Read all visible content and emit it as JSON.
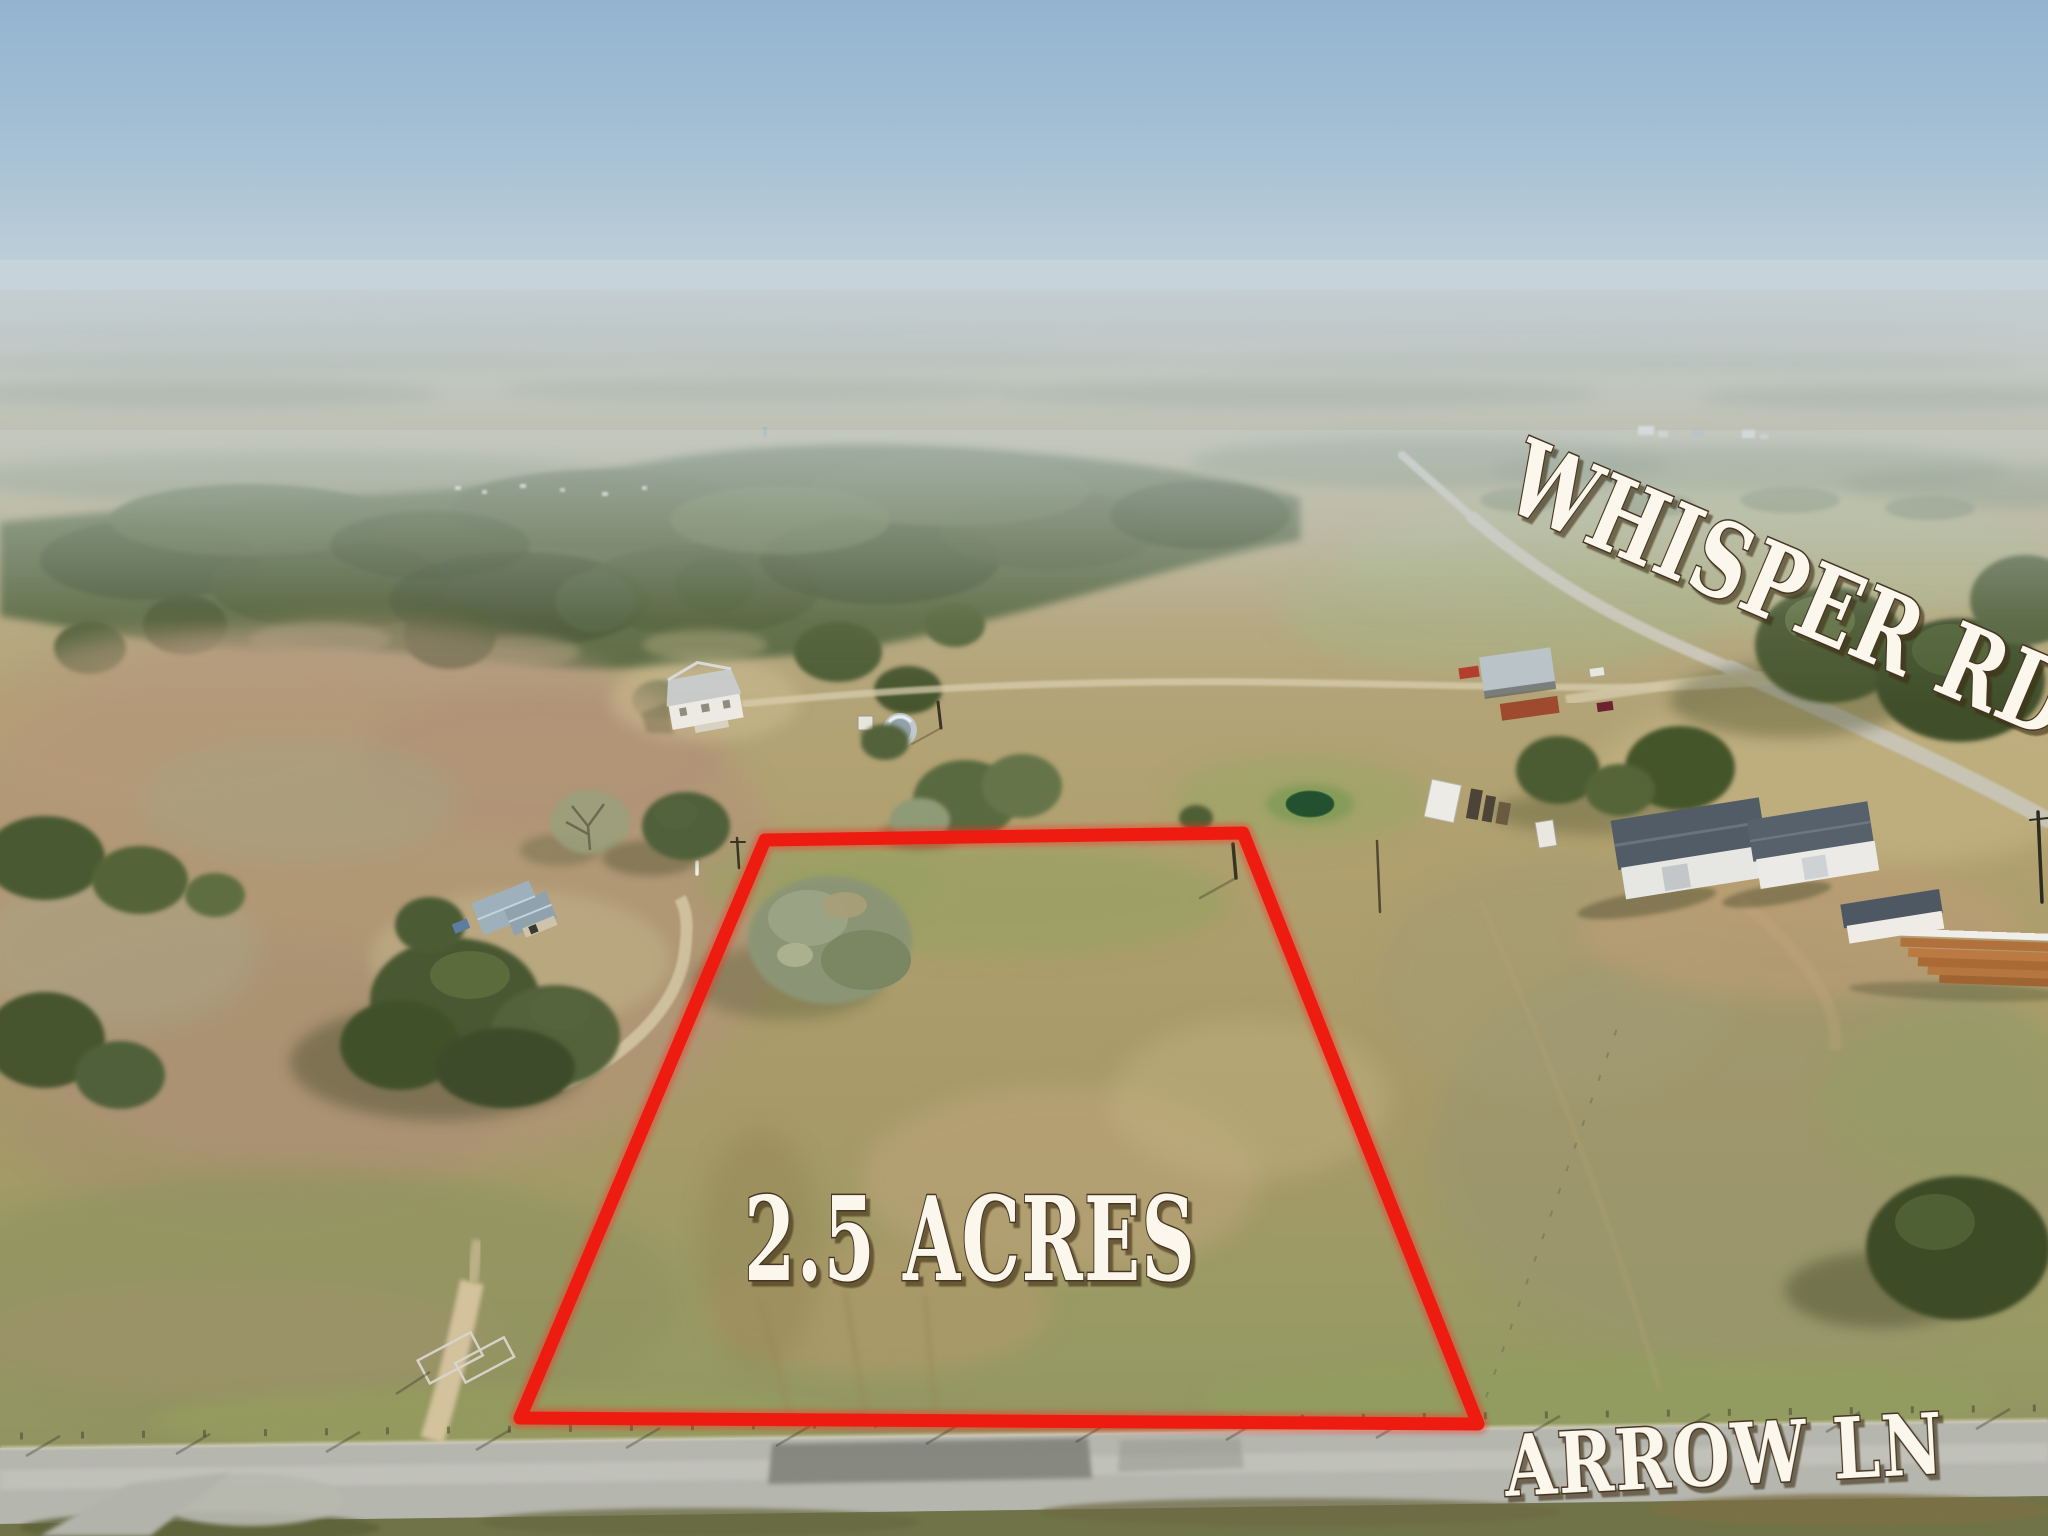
{
  "scene": {
    "setting": "aerial drone photo of flat rural ranch land with a marked lot for sale",
    "sky_top_color": "#93b4d0",
    "field_tan_color": "#b2a06e",
    "pasture_pink_color": "#b2937b",
    "tree_green_color": "#4e5d35"
  },
  "overlays": {
    "lot_size": "2.5 ACRES",
    "road_top": "WHISPER RD",
    "road_bottom": "ARROW LN"
  },
  "labels_style": {
    "text_color": "#fbf7ec",
    "outline_color": "#463420"
  },
  "lot": {
    "outline_color": "#ee1b10",
    "outline_width_px": 13,
    "outline_points": "765,840 1243,833 1478,1424 520,1418"
  }
}
